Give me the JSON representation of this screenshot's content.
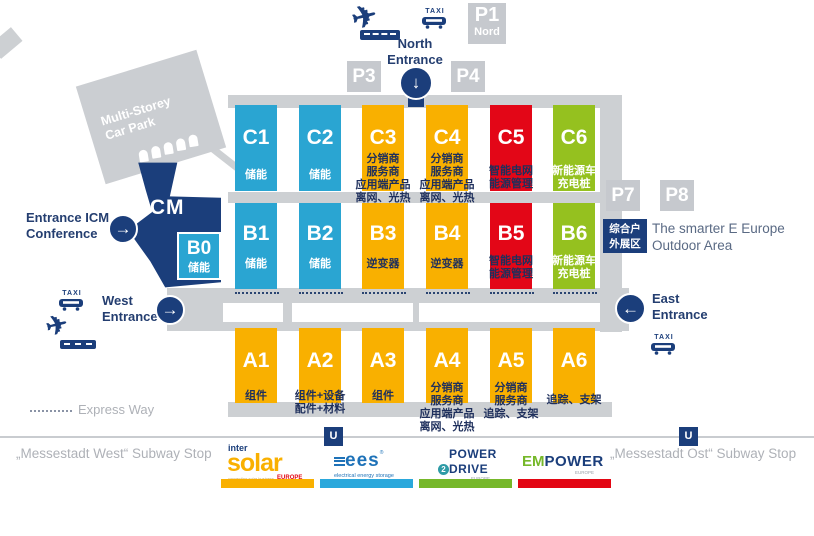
{
  "colors": {
    "cyan": "#2AA5D2",
    "yellow": "#F9B000",
    "red": "#E30617",
    "green": "#95C11F",
    "navy": "#1B3E7B",
    "gray": "#CDD0D3",
    "parking_gray": "#C6C9CE",
    "intersolar_bar": "#F9B000",
    "ees_bar": "#2AA8DC",
    "power2drive_bar": "#76B82A",
    "empower_bar": "#E30613"
  },
  "parking": {
    "p1": {
      "label": "P1",
      "sub": "Nord"
    },
    "p3": "P3",
    "p4": "P4",
    "p7": "P7",
    "p8": "P8"
  },
  "taxi_label": "TAXI",
  "car_park": {
    "lines": [
      "Multi-Storey",
      "Car Park"
    ]
  },
  "icm": {
    "label": "ICM"
  },
  "entrances": {
    "north": {
      "lines": [
        "North",
        "Entrance"
      ],
      "arrow": "↓"
    },
    "icm_conference": {
      "lines": [
        "Entrance ICM",
        "Conference"
      ],
      "arrow": "→"
    },
    "west": {
      "lines": [
        "West",
        "Entrance"
      ],
      "arrow": "→"
    },
    "east": {
      "lines": [
        "East",
        "Entrance"
      ],
      "arrow": "←"
    }
  },
  "halls": {
    "c": [
      {
        "id": "C1",
        "type": "cyan",
        "cat_style": "light",
        "cat": [
          "储能"
        ]
      },
      {
        "id": "C2",
        "type": "cyan",
        "cat_style": "light",
        "cat": [
          "储能"
        ]
      },
      {
        "id": "C3",
        "type": "yellow",
        "cat_style": "dark",
        "cat": [
          "分销商",
          "服务商",
          "应用端产品",
          "离网、光热"
        ]
      },
      {
        "id": "C4",
        "type": "yellow",
        "cat_style": "dark",
        "cat": [
          "分销商",
          "服务商",
          "应用端产品",
          "离网、光热"
        ]
      },
      {
        "id": "C5",
        "type": "red",
        "cat_style": "dark",
        "cat": [
          "智能电网",
          "能源管理"
        ]
      },
      {
        "id": "C6",
        "type": "green",
        "cat_style": "light",
        "cat": [
          "新能源车",
          "充电桩"
        ]
      }
    ],
    "b": [
      {
        "id": "B0",
        "type": "cyan",
        "cat_style": "light",
        "cat": [
          "储能"
        ]
      },
      {
        "id": "B1",
        "type": "cyan",
        "cat_style": "light",
        "cat": [
          "储能"
        ]
      },
      {
        "id": "B2",
        "type": "cyan",
        "cat_style": "light",
        "cat": [
          "储能"
        ]
      },
      {
        "id": "B3",
        "type": "yellow",
        "cat_style": "dark",
        "cat": [
          "逆变器"
        ]
      },
      {
        "id": "B4",
        "type": "yellow",
        "cat_style": "dark",
        "cat": [
          "逆变器"
        ]
      },
      {
        "id": "B5",
        "type": "red",
        "cat_style": "dark",
        "cat": [
          "智能电网",
          "能源管理"
        ]
      },
      {
        "id": "B6",
        "type": "green",
        "cat_style": "light",
        "cat": [
          "新能源车",
          "充电桩"
        ]
      }
    ],
    "a": [
      {
        "id": "A1",
        "type": "yellow",
        "cat_style": "dark",
        "cat": [
          "组件"
        ]
      },
      {
        "id": "A2",
        "type": "yellow",
        "cat_style": "dark",
        "cat": [
          "组件+设备",
          "配件+材料"
        ]
      },
      {
        "id": "A3",
        "type": "yellow",
        "cat_style": "dark",
        "cat": [
          "组件"
        ]
      },
      {
        "id": "A4",
        "type": "yellow",
        "cat_style": "dark",
        "cat": [
          "分销商",
          "服务商",
          "应用端产品",
          "离网、光热"
        ]
      },
      {
        "id": "A5",
        "type": "yellow",
        "cat_style": "dark",
        "cat": [
          "分销商",
          "服务商",
          "追踪、支架"
        ]
      },
      {
        "id": "A6",
        "type": "yellow",
        "cat_style": "dark",
        "cat": [
          "追踪、支架"
        ]
      }
    ]
  },
  "outdoor": {
    "box_lines": [
      "综合户",
      "外展区"
    ],
    "label_lines": [
      "The smarter E Europe",
      "Outdoor Area"
    ]
  },
  "express_way": "Express Way",
  "subway": {
    "u": "U",
    "west": "„Messestadt West“ Subway Stop",
    "ost": "„Messestadt Ost“ Subway Stop"
  },
  "logos": {
    "intersolar": {
      "inter": "inter",
      "solar": "solar",
      "tagline": "connecting solar business",
      "europe": "EUROPE",
      "bar_color": "#F9B000"
    },
    "ees": {
      "name": "ees",
      "reg": "®",
      "sub": "electrical energy storage",
      "bar_color": "#2AA8DC"
    },
    "power2drive": {
      "power": "POWER",
      "two": "2",
      "drive": "DRIVE",
      "europe": "EUROPE",
      "bar_color": "#76B82A"
    },
    "empower": {
      "em": "EM",
      "power": "POWER",
      "europe": "EUROPE",
      "bar_color": "#E30613"
    }
  }
}
